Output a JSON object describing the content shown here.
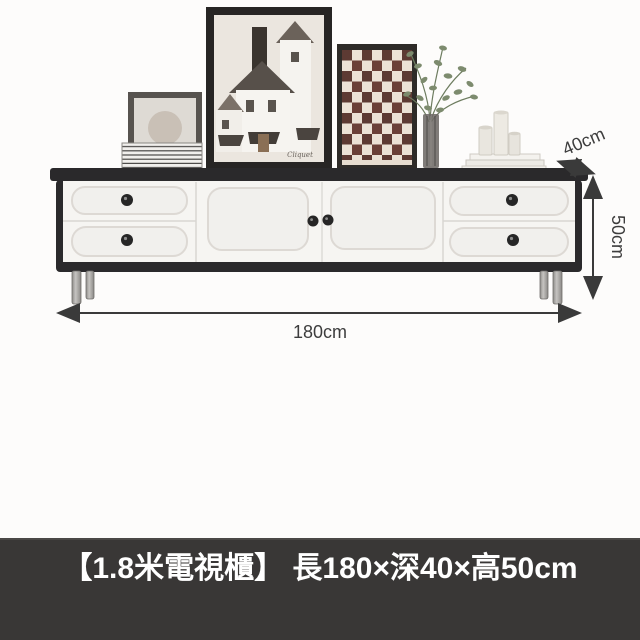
{
  "annotations": {
    "width_label": "180cm",
    "depth_label": "40cm",
    "height_label": "50cm"
  },
  "caption": {
    "text": "【1.8米電視櫃】 長180×深40×高50cm"
  },
  "art": {
    "signature": "Cliquet"
  },
  "colors": {
    "cabinet_frame": "#2b2a2c",
    "drawer_face": "#f6f5f2",
    "panel_inset": "#f1f0ed",
    "knob": "#262626",
    "leg_silver": "#a9a7a4",
    "annotation_text": "#3d3d3d",
    "arrow": "#3a3a3a",
    "caption_bar_bg": "#393736",
    "caption_text": "#ffffff",
    "checker_dark": "#5d3a33",
    "checker_light": "#ece2d6",
    "plant_green": "#7d8b6e",
    "art_frame": "#272524",
    "art_mat": "#ebe6df"
  }
}
